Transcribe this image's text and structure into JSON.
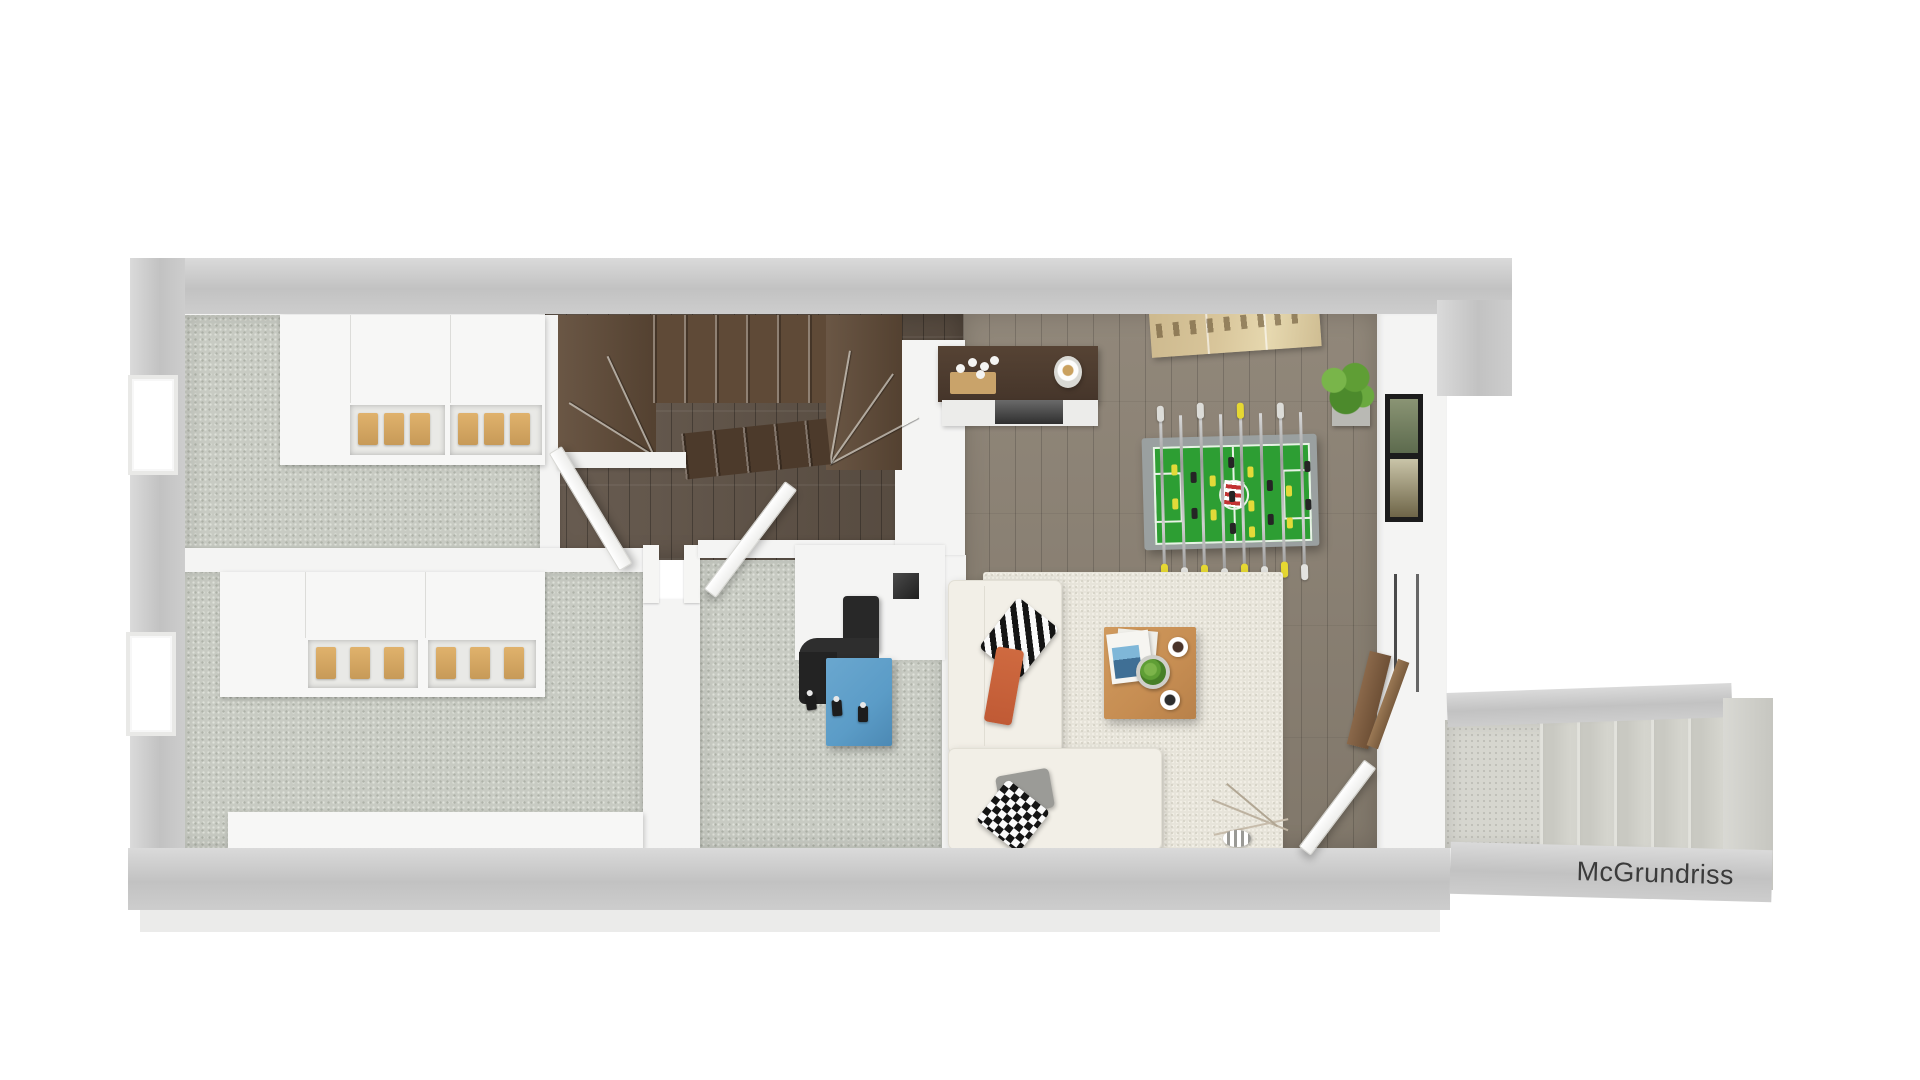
{
  "watermark": {
    "label": "McGrundriss"
  },
  "palette": {
    "wall_band": "#c2c2c2",
    "wall_band_light": "#dadada",
    "wall_face": "#f4f4f3",
    "carpet": "#c8cbc3",
    "carpet_dot": "#aeb2a8",
    "wood_hall": "#5d5044",
    "wood_living": "#8b8173",
    "wood_stairs": "#5f4a37",
    "rug": "#e7e4da",
    "sofa": "#f2efe7",
    "table_wood": "#c68d52",
    "foosball_frame": "#9aa0a0",
    "foosball_green": "#2d9e33",
    "player_yellow": "#e3da39",
    "player_black": "#252525",
    "unit_blue": "#5b9cc7",
    "pipe": "#282828",
    "plant": "#5f9e35",
    "artwork": "#d8c59a",
    "sideboard_wood": "#45352a",
    "orange_throw": "#c05a35",
    "annex_floor": "#d6d6cf",
    "text": "#3b3b3b"
  },
  "scene": {
    "type": "3d-floor-plan-top-down-render",
    "areas": [
      "carpet-room-top-left",
      "carpet-room-bottom-left",
      "carpet-room-center",
      "hallway-with-winder-stairs",
      "living-room",
      "exterior-stair-annex"
    ],
    "objects": [
      "wardrobe-with-open-shelves",
      "wardrobe-with-open-shelves",
      "long-counter",
      "winder-staircase-dark-wood",
      "interior-doors",
      "chimney-block-with-vent",
      "blue-cabinet-with-stove-pipe-and-taps",
      "sideboard-with-candles-and-vase",
      "panoramic-artwork",
      "potted-plant",
      "two-picture-frames",
      "foosball-table",
      "area-rug",
      "l-shaped-sofa-with-pillows",
      "square-coffee-table-with-magazines-plant-cups",
      "decorative-branches-and-bowl",
      "leaning-wood-boards",
      "glass-door-rails",
      "exterior-stairs"
    ]
  }
}
